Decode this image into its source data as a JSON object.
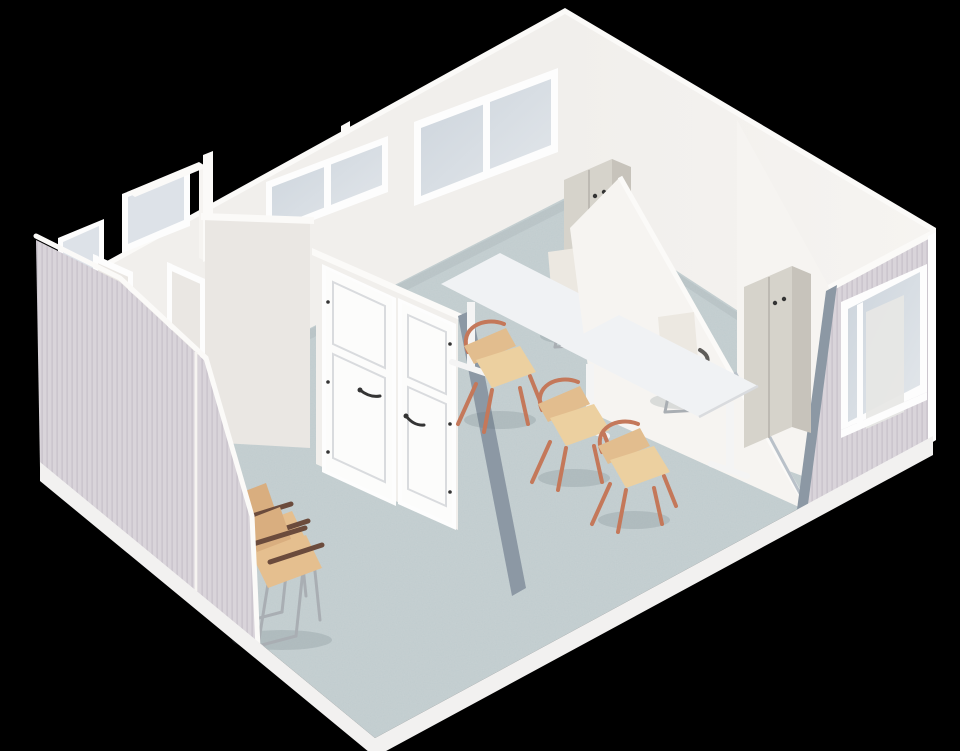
{
  "meta": {
    "description": "Isometric cutaway 3D architectural render of a modular office interior on a black background",
    "view": "isometric cutaway",
    "background": "black"
  },
  "colors": {
    "bg": "#000000",
    "wall": "#f1efec",
    "wall_shadow": "#eae7e3",
    "wall_bright": "#f6f4f1",
    "wall_cap": "#fbfaf8",
    "ribbed": "#d9d4da",
    "ribbed_line": "#cac4cd",
    "floor": "#c7d1d3",
    "plinth": "#f2f1f0",
    "glass": "#ccd4dc",
    "glass_light": "#e3e7eb",
    "frost": "#dde2e8",
    "frame": "#fdfdfd",
    "cut_slate": "#8c98a4",
    "cut_light": "#b9c1c9",
    "cabinet_front": "#d6d3cb",
    "cabinet_side": "#c7c3bb",
    "cabinet_top": "#eae8e3",
    "cabinet_seam": "#b7b4ad",
    "desk_top": "#f0f2f4",
    "desk_edge": "#d9dbde",
    "leg_white": "#f4f4f4",
    "chair_white": "#ece8e1",
    "chair_white_dark": "#e2ded6",
    "armrest_gray": "#5f5d5a",
    "chrome": "#a9aeb3",
    "copper": "#c4785a",
    "wood_seat": "#ecd0a0",
    "wood_back": "#e2bd8e",
    "tan_seat": "#e5bf8f",
    "tan_back": "#d9ae7f",
    "armrest_brown": "#6b4b3c",
    "handle_dark": "#343434",
    "shadow": "rgba(90,105,112,0.18)"
  },
  "scene": {
    "areas": [
      {
        "label": "back-left cubicle rooms"
      },
      {
        "label": "corridor with double doors"
      },
      {
        "label": "main open office"
      },
      {
        "label": "right side room"
      }
    ],
    "objects": [
      {
        "label": "exterior ribbed wall (left, cutaway)",
        "count": 1
      },
      {
        "label": "exterior ribbed wall with window (right)",
        "count": 1
      },
      {
        "label": "back wall double window",
        "count": 1
      },
      {
        "label": "interior glazed band",
        "count": 1
      },
      {
        "label": "frosted cubicle windows",
        "count": 2
      },
      {
        "label": "white paneled interior doors",
        "count": 2
      },
      {
        "label": "open door frames",
        "count": 2
      },
      {
        "label": "white desks",
        "count": 2
      },
      {
        "label": "white office chairs",
        "count": 2
      },
      {
        "label": "wooden chairs with copper frame",
        "count": 3
      },
      {
        "label": "tan waiting chairs",
        "count": 2
      },
      {
        "label": "grey double-door cabinets",
        "count": 2
      },
      {
        "label": "speckled vinyl floor slab",
        "count": 1
      }
    ]
  }
}
